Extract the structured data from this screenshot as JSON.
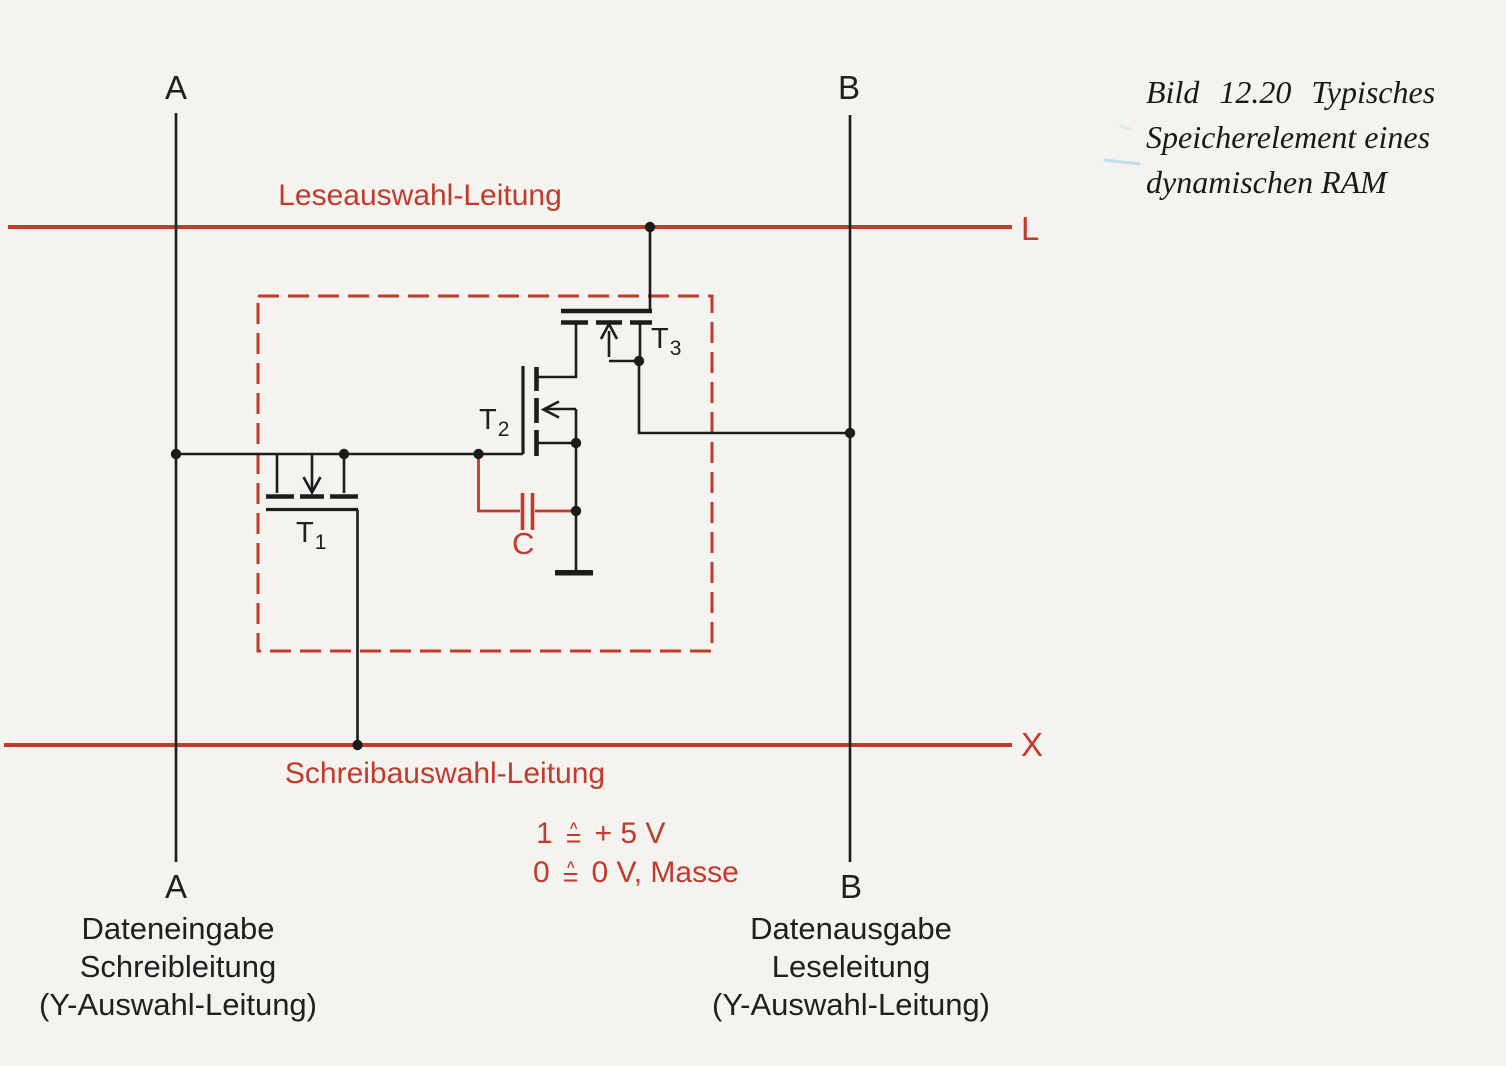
{
  "figure_caption": {
    "line1": "Bild 12.20 Typisches",
    "line2": "Speicherelement eines",
    "line3": "dynamischen RAM"
  },
  "bus_lines": {
    "read_select": {
      "label": "Leseauswahl-Leitung",
      "terminal": "L"
    },
    "write_select": {
      "label": "Schreibauswahl-Leitung",
      "terminal": "X"
    }
  },
  "legend": {
    "one": "1",
    "one_value": "+ 5 V",
    "zero": "0",
    "zero_value": "0 V, Masse",
    "sym_hat": "∧",
    "sym_eq": "="
  },
  "terminals": {
    "a_top": "A",
    "b_top": "B",
    "a_bottom": "A",
    "b_bottom": "B",
    "a_desc": [
      "Dateneingabe",
      "Schreibleitung",
      "(Y-Auswahl-Leitung)"
    ],
    "b_desc": [
      "Datenausgabe",
      "Leseleitung",
      "(Y-Auswahl-Leitung)"
    ]
  },
  "components": {
    "t1": {
      "base": "T",
      "sub": "1"
    },
    "t2": {
      "base": "T",
      "sub": "2"
    },
    "t3": {
      "base": "T",
      "sub": "3"
    },
    "capacitor": "C"
  },
  "colors": {
    "line_red": "#c23a2c",
    "wire_black": "#1c1c1c",
    "background": "#f4f3ef"
  }
}
